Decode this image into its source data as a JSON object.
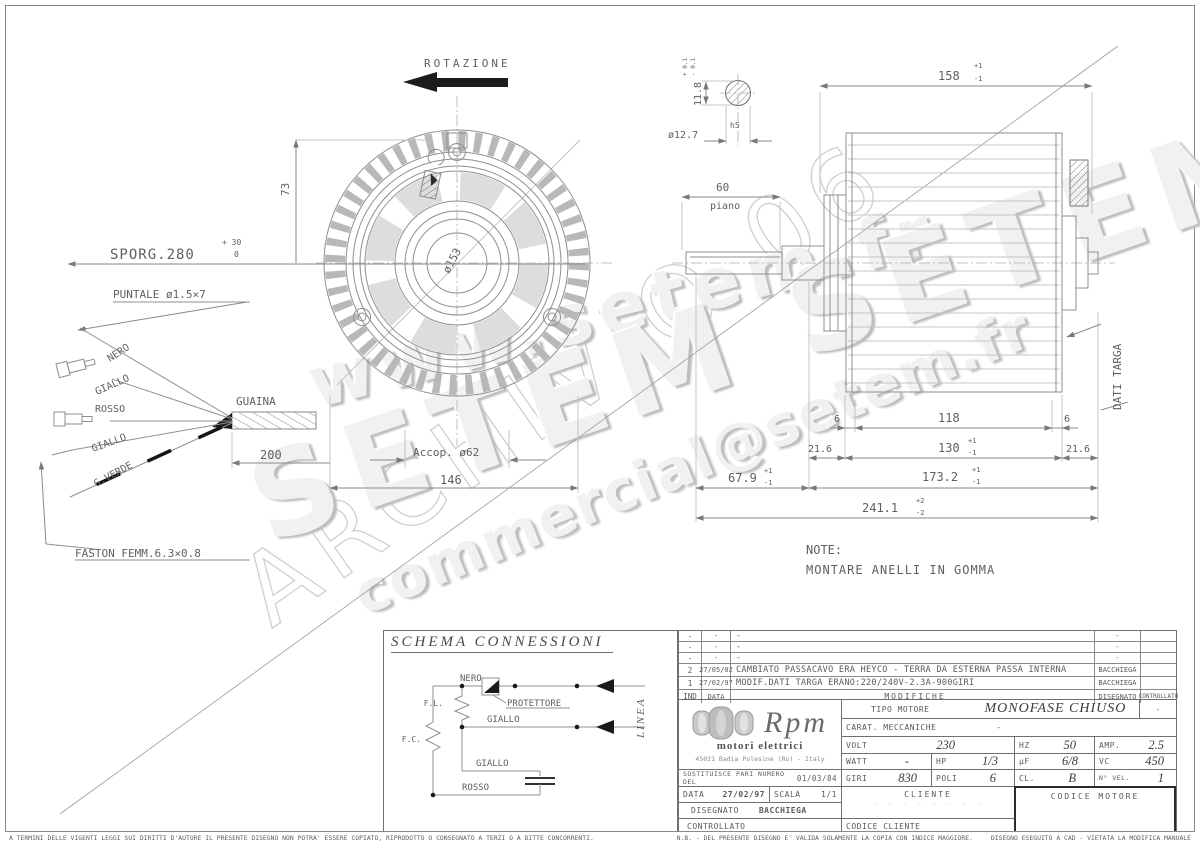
{
  "watermarks": {
    "w1": "www.setem.fr",
    "w2": "SETEM  SETEM",
    "w3": "commercial@setem.fr",
    "w4": "ARCHIVIO 06"
  },
  "d": {
    "rotazione": "ROTAZIONE",
    "sporg": "SPORG.280",
    "sporg_p": "+ 30",
    "sporg_0": "0",
    "puntale": "PUNTALE  ø1.5×7",
    "nero": "NERO",
    "giallo": "GIALLO",
    "rosso": "ROSSO",
    "gverde": "G.VERDE",
    "guaina": "GUAINA",
    "d200": "200",
    "faston": "FASTON FEMM.6.3×0.8",
    "d73": "73",
    "accop": "Accop.  ø62",
    "d146": "146",
    "hub": "ø153",
    "d158": "158",
    "p1": "+1",
    "m1": "-1",
    "d60": "60",
    "piano": "piano",
    "d118v": "11.8",
    "tolp01": "+ 0.1",
    "tolm01": "- 0.1",
    "dia127": "ø12.7",
    "h5": "h5",
    "d6": "6",
    "d118": "118",
    "d216": "21.6",
    "d130": "130",
    "d679": "67.9",
    "d1732": "173.2",
    "d2411": "241.1",
    "p2": "+2",
    "m2": "-2",
    "dati": "DATI TARGA",
    "note1": "NOTE:",
    "note2": "MONTARE ANELLI IN GOMMA"
  },
  "schema": {
    "title": "SCHEMA CONNESSIONI",
    "linea": "LINEA",
    "nero": "NERO",
    "protettore": "PROTETTORE",
    "giallo": "GIALLO",
    "rosso": "ROSSO",
    "fl": "F.L.",
    "fc": "F.C."
  },
  "tb": {
    "mod": {
      "header": {
        "ind": "IND",
        "date": "DATA",
        "desc": "MODIFICHE",
        "by": "DISEGNATO",
        "chk": "CONTROLLATO"
      },
      "rows": [
        {
          "ind": "-",
          "date": "-",
          "desc": "-",
          "by": "-",
          "chk": ""
        },
        {
          "ind": "-",
          "date": "-",
          "desc": "-",
          "by": "-",
          "chk": ""
        },
        {
          "ind": "-",
          "date": "-",
          "desc": "-",
          "by": "-",
          "chk": ""
        },
        {
          "ind": "2",
          "date": "27/05/02",
          "desc": "CAMBIATO PASSACAVO ERA HEYCO - TERRA DA ESTERNA PASSA INTERNA",
          "by": "BACCHIEGA",
          "chk": ""
        },
        {
          "ind": "1",
          "date": "27/02/97",
          "desc": "MODIF.DATI TARGA ERANO:220/240V-2.3A-900GIRI",
          "by": "BACCHIEGA",
          "chk": ""
        }
      ]
    },
    "logo": {
      "brand": "Rpm",
      "sub": "motori elettrici",
      "addr": "45021 Badia Polesine (Ro) - Italy"
    },
    "tipo_l": "TIPO MOTORE",
    "tipo_v": "MONOFASE CHIUSO",
    "dash": "-",
    "carat_l": "CARAT. MECCANICHE",
    "carat_v": "-",
    "volt_l": "VOLT",
    "volt_v": "230",
    "hz_l": "HZ",
    "hz_v": "50",
    "amp_l": "AMP.",
    "amp_v": "2.5",
    "watt_l": "WATT",
    "watt_v": "-",
    "hp_l": "HP",
    "hp_v": "1/3",
    "uf_l": "µF",
    "uf_v": "6/8",
    "vc_l": "VC",
    "vc_v": "450",
    "sost_l": "SOSTITUISCE PARI NUMERO DEL",
    "sost_v": "01/03/84",
    "giri_l": "GIRI",
    "giri_v": "830",
    "poli_l": "POLI",
    "poli_v": "6",
    "cl_l": "CL.",
    "cl_v": "B",
    "nvel_l": "N° VEL.",
    "nvel_v": "1",
    "data_l": "DATA",
    "data_v": "27/02/97",
    "scala_l": "SCALA",
    "scala_v": "1/1",
    "dis_l": "DISEGNATO",
    "dis_v": "BACCHIEGA",
    "ctrl_l": "CONTROLLATO",
    "cliente": "CLIENTE",
    "ghost": "- - - - - - - -",
    "codmot": "CODICE MOTORE",
    "codcli": "CODICE CLIENTE"
  },
  "footer": {
    "left": "A TERMINI DELLE VIGENTI LEGGI SUI DIRITTI D'AUTORE IL PRESENTE DISEGNO NON POTRA' ESSERE COPIATO, RIPRODOTTO O CONSEGNATO A TERZI O A DITTE CONCORRENTI.",
    "nb": "N.B. - DEL PRESENTE DISEGNO E' VALIDA SOLAMENTE LA COPIA CON INDICE MAGGIORE.",
    "cad": "DISEGNO ESEGUITO A CAD - VIETATA LA MODIFICA MANUALE"
  }
}
